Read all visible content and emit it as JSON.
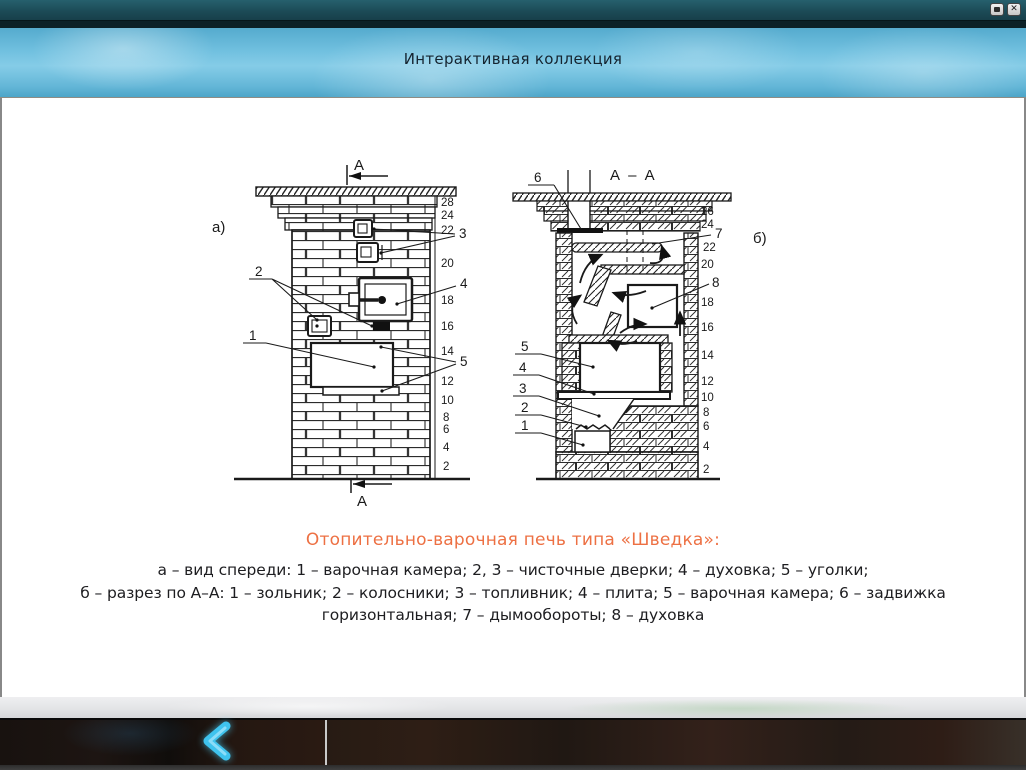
{
  "window": {
    "icons": {
      "minimize": "square",
      "close": "x",
      "back": "chevron-left"
    }
  },
  "header": {
    "title": "Интерактивная коллекция"
  },
  "figure": {
    "left": {
      "view_label": "а)",
      "section_letter": "А",
      "parts": [
        "1",
        "2",
        "3",
        "4",
        "5"
      ],
      "course_numbers": [
        "28",
        "24",
        "22",
        "20",
        "18",
        "16",
        "14",
        "12",
        "10",
        "8",
        "6",
        "4",
        "2"
      ]
    },
    "right": {
      "view_label": "б)",
      "section_title": "А – А",
      "parts": [
        "1",
        "2",
        "3",
        "4",
        "5",
        "6",
        "7",
        "8"
      ],
      "course_numbers": [
        "26",
        "24",
        "22",
        "20",
        "18",
        "16",
        "14",
        "12",
        "10",
        "8",
        "6",
        "4",
        "2"
      ]
    }
  },
  "caption": {
    "title": "Отопительно-варочная печь типа «Шведка»:",
    "line1": "а – вид спереди: 1 – варочная камера; 2, 3 – чисточные дверки; 4 – духовка; 5 – уголки;",
    "line2": "б – разрез по А–А: 1 – зольник; 2 – колосники; 3 – топливник; 4 – плита; 5 – варочная камера; 6 – задвижка горизонтальная; 7 – дымообороты; 8 – духовка"
  },
  "colors": {
    "accent_orange": "#ed7043",
    "header_blue": "#72c1e0",
    "titlebar_teal": "#1c4b57",
    "chevron_blue": "#3fc3ee"
  }
}
